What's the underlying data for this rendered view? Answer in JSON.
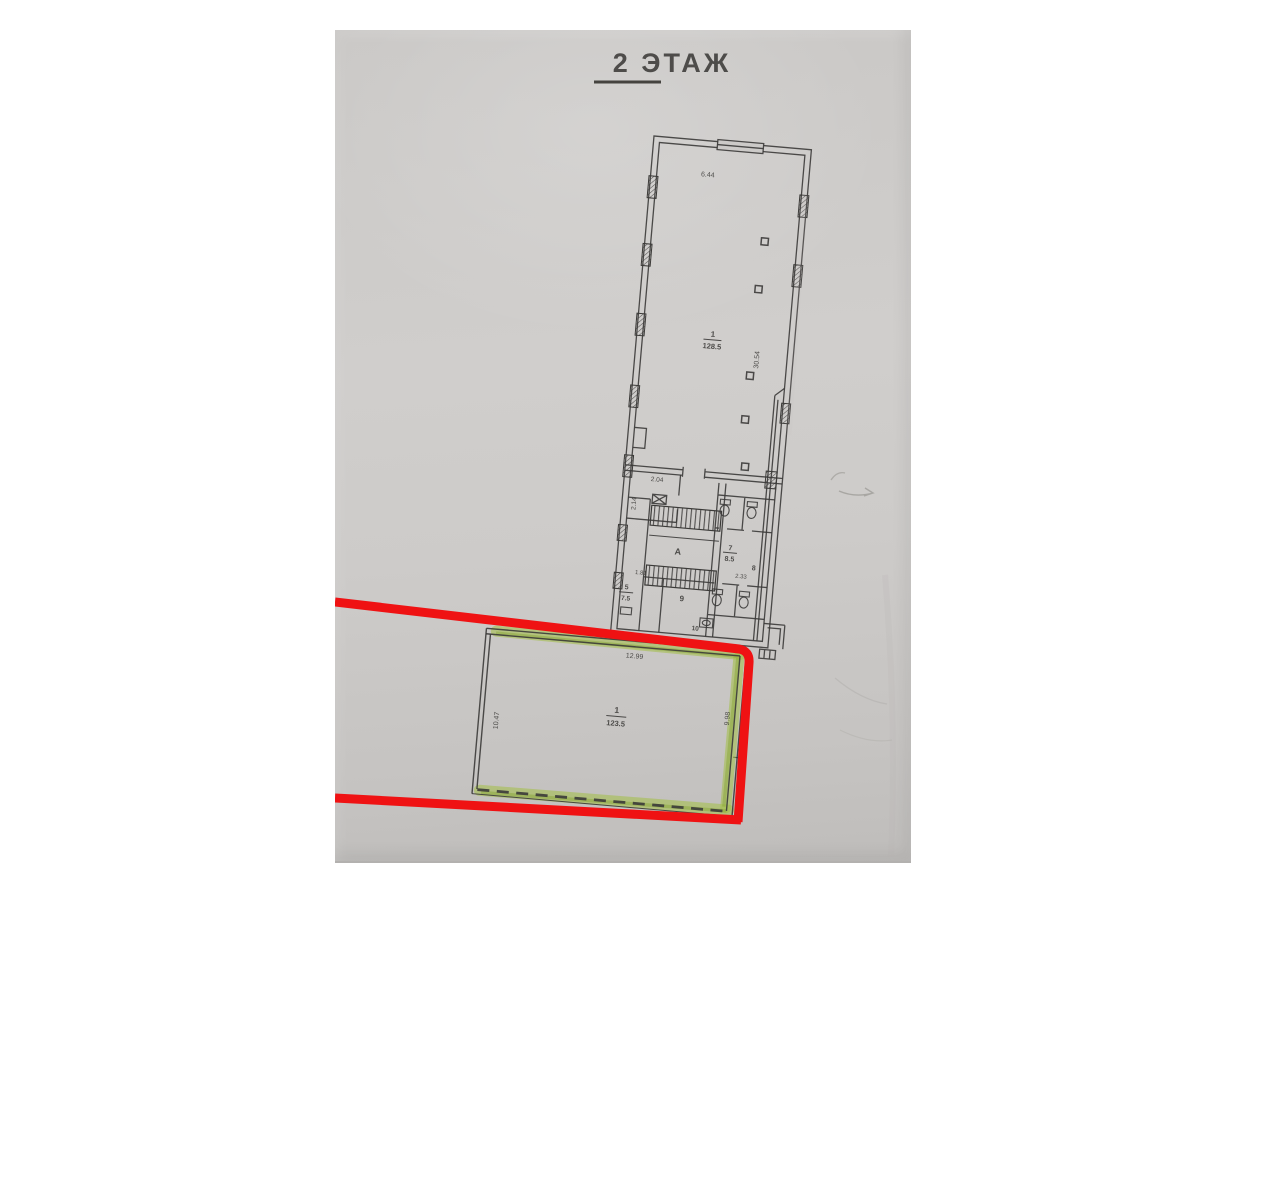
{
  "plan": {
    "title": "2 ЭТАЖ",
    "building": {
      "dim_top": "6.44",
      "dim_right": "30.54",
      "room_main_no": "1",
      "room_main_area": "128.5",
      "dim_vestibule_w": "2.04",
      "dim_vestibule_h": "2.14",
      "stair_letter": "А",
      "room_wc_no": "7",
      "room_wc_area": "8.5",
      "dim_wc": "2.33",
      "dim_small": "1.81",
      "room_left_no": "5",
      "room_left_area": "7.5",
      "room_center_no": "9",
      "room_right_no": "8",
      "room_bottom_no": "10"
    },
    "annex": {
      "room_no": "1",
      "room_area": "123.5",
      "dim_top": "12.99",
      "dim_left": "10.47",
      "dim_right": "9.98"
    },
    "colors": {
      "paper": "#cccac8",
      "ink": "#3b3a38",
      "marker_red": "#ef1213",
      "highlighter_green": "#a4c04a"
    }
  }
}
